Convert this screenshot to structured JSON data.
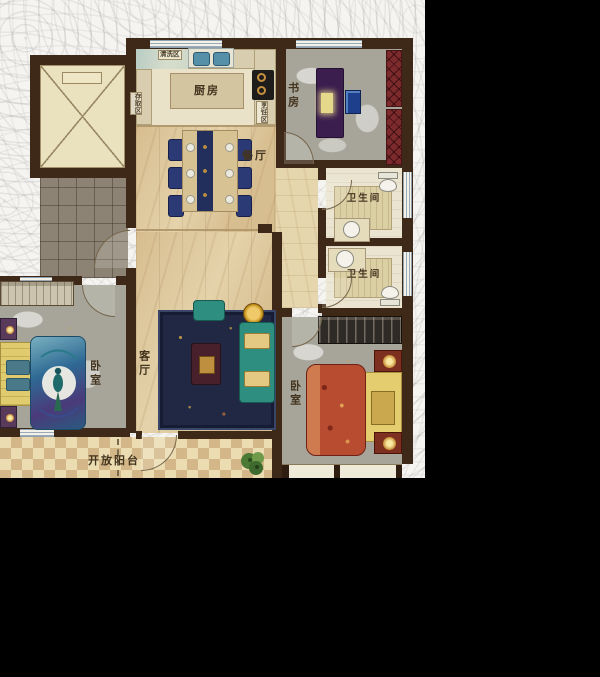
{
  "scene": {
    "background": "#000000"
  },
  "plan": {
    "rooms": {
      "kitchen": {
        "label": "厨房"
      },
      "study": {
        "label": "书房"
      },
      "dining": {
        "label": "餐厅"
      },
      "living": {
        "label": "客厅"
      },
      "bathroom_top": {
        "label": "卫生间"
      },
      "bathroom_bottom": {
        "label": "卫生间"
      },
      "bedroom_left": {
        "label": "卧室"
      },
      "bedroom_right": {
        "label": "卧室"
      },
      "balcony": {
        "label": "开放阳台"
      }
    },
    "kitchen_zones": {
      "storage": {
        "label": "存取区"
      },
      "washing": {
        "label": "清洗区"
      },
      "cooking": {
        "label": "烹饪区"
      }
    },
    "colors": {
      "wall": "#3e2817",
      "wood_floor": "#ddc79c",
      "gray_room": "#a7a59a",
      "rug": "#202844",
      "sofa": "#2e8f80",
      "bookshelf": "#7c2a2c",
      "desk": "#3b1e4e",
      "bed_left_quilt": "#2e6a94",
      "bed_right_quilt": "#b84c30",
      "bed_frame_gold": "#e0cc6e",
      "balcony_tile_light": "#ecdcb2",
      "balcony_tile_dark": "#d3b788",
      "corridor_tile": "#8d8374",
      "elevator_fill": "#eae1bf",
      "background": "#000000"
    }
  }
}
